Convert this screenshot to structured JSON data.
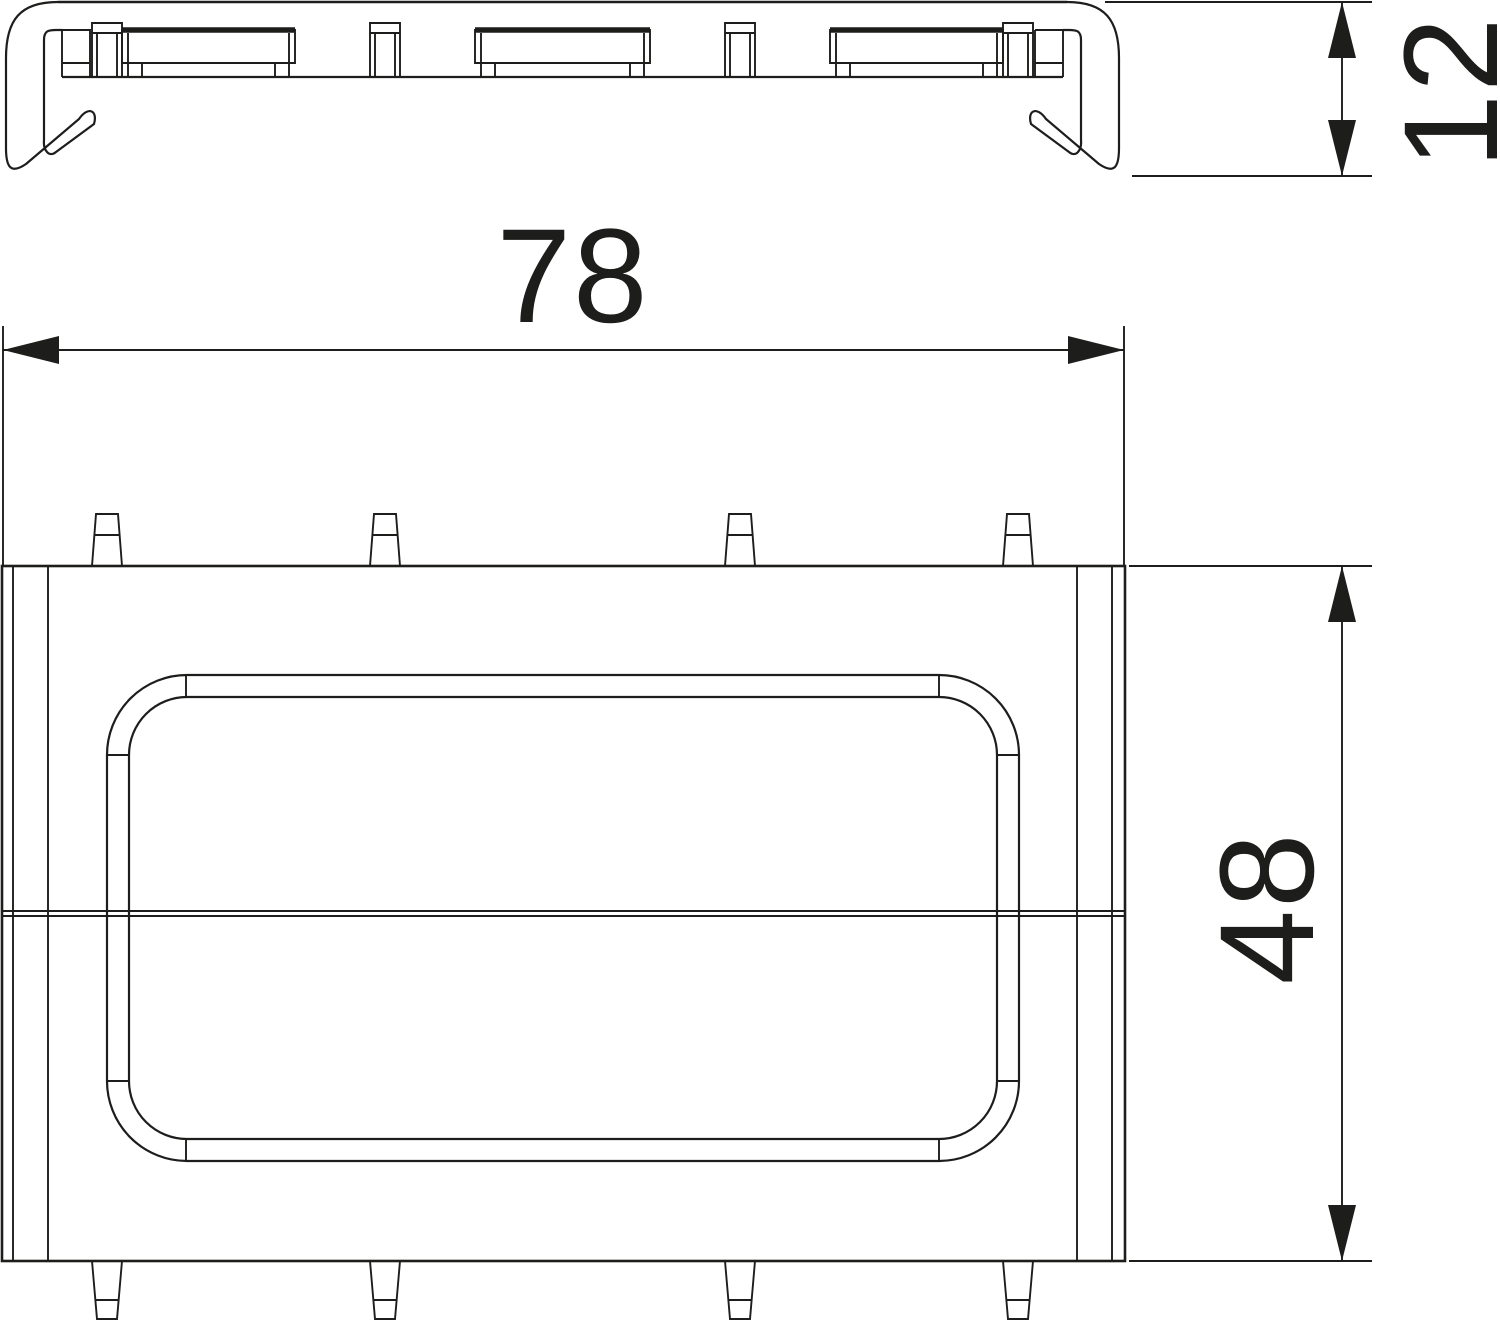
{
  "drawing": {
    "type": "technical-dimension-drawing",
    "background_color": "#ffffff",
    "line_color": "#1d1d1b",
    "dimensions": {
      "width": {
        "label": "78"
      },
      "height": {
        "label": "48"
      },
      "depth": {
        "label": "12"
      }
    }
  }
}
